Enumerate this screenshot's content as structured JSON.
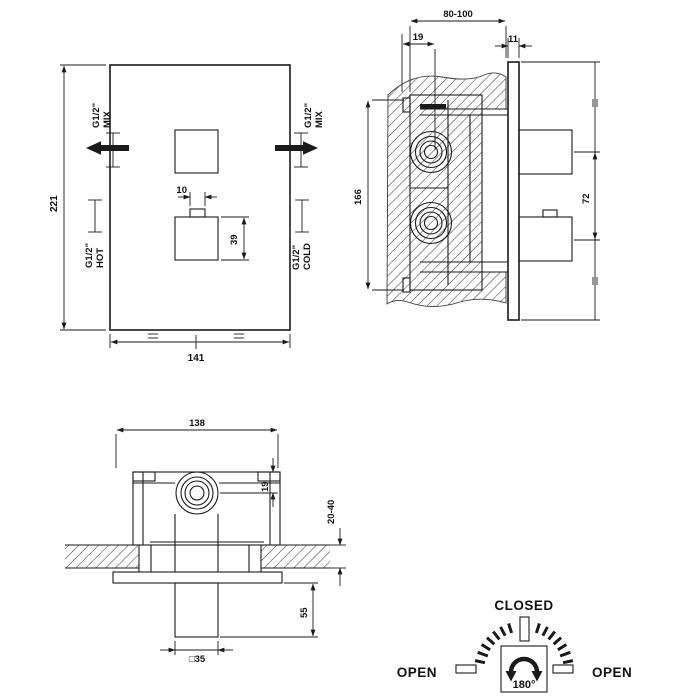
{
  "drawing": {
    "front_view": {
      "dims": {
        "height": "221",
        "width": "141",
        "handle_stem": "10",
        "handle_size": "39"
      },
      "ports": {
        "mix_left": [
          "G1/2\"",
          "MIX"
        ],
        "mix_right": [
          "G1/2\"",
          "MIX"
        ],
        "hot": [
          "G1/2\"",
          "HOT"
        ],
        "cold": [
          "G1/2\"",
          "COLD"
        ]
      }
    },
    "side_view": {
      "dims": {
        "depth_range": "80-100",
        "axis_offset": "19",
        "plate_thickness": "11",
        "box_height": "166",
        "handle_spacing": "72"
      }
    },
    "top_view": {
      "dims": {
        "box_width": "138",
        "axis_offset": "19",
        "wall_range": "20-40",
        "handle_length": "55",
        "handle_square": "□35"
      }
    },
    "dial": {
      "closed": "CLOSED",
      "open_left": "OPEN",
      "open_right": "OPEN",
      "angle": "180°"
    }
  },
  "colors": {
    "line": "#1a1a1a",
    "background": "#ffffff"
  }
}
